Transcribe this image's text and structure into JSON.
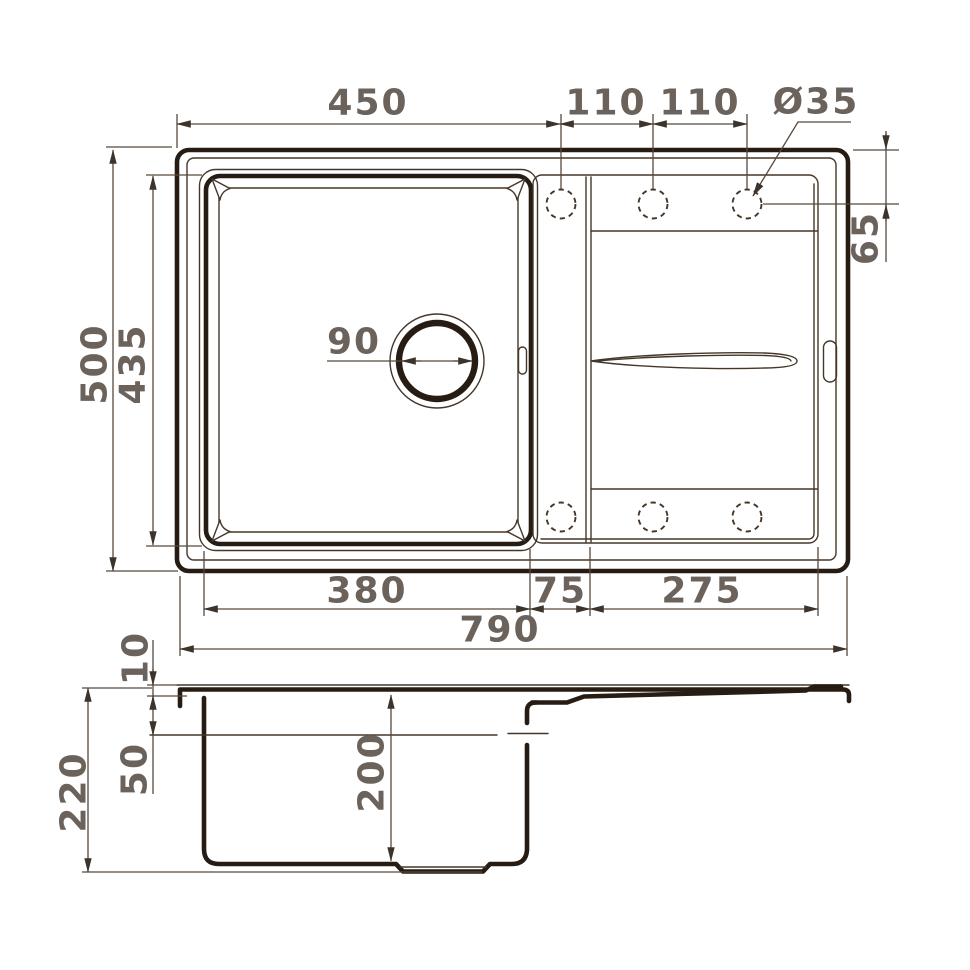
{
  "top_view": {
    "dim_width_left": "450",
    "dim_hole_spacing_a": "110",
    "dim_hole_spacing_b": "110",
    "dim_hole_diameter": "Ø35",
    "dim_hole_offset": "65",
    "dim_depth_total": "500",
    "dim_bowl_depth": "435",
    "dim_drain_diameter": "90",
    "dim_bowl_width": "380",
    "dim_step_width": "75",
    "dim_drainboard_width": "275",
    "dim_width_total": "790"
  },
  "side_view": {
    "dim_rim_thickness": "10",
    "dim_ledge_depth": "50",
    "dim_height_total": "220",
    "dim_bowl_depth": "200"
  },
  "colors": {
    "outline_ink": "#261c13",
    "thin_line": "#443729",
    "dimension_line": "#57493c",
    "label_text": "#6b625b",
    "background": "#ffffff"
  }
}
